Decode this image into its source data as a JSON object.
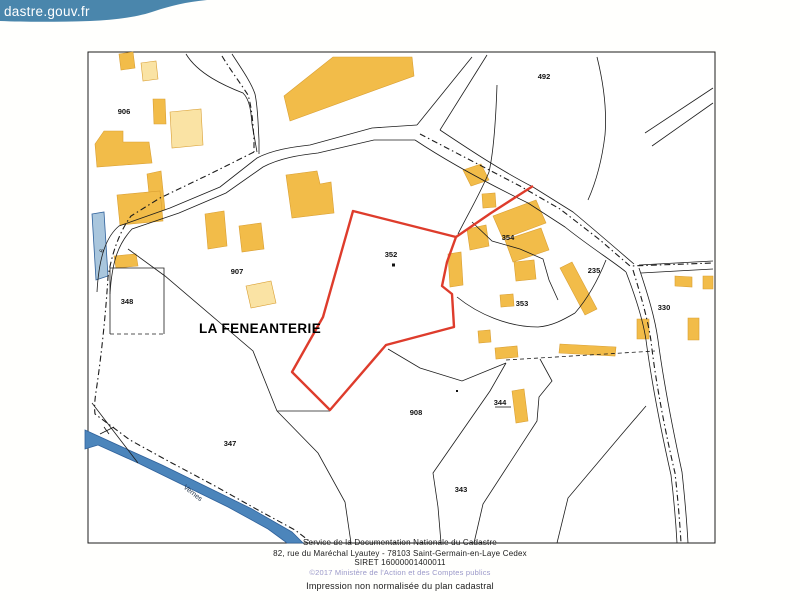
{
  "banner": {
    "logo": "dastre.gouv.fr",
    "background": "#4A86AC",
    "text_color": "#FFFFFF"
  },
  "map": {
    "place": "LA FENEANTERIE",
    "river": "Vernes",
    "road_marker": "6",
    "highlighted_parcel": "352",
    "parcels": {
      "p906": "906",
      "p907": "907",
      "p352": "352",
      "p354": "354",
      "p492": "492",
      "p235": "235",
      "p330": "330",
      "p353": "353",
      "p348": "348",
      "p908": "908",
      "p344": "344",
      "p343": "343",
      "p347": "347"
    },
    "colors": {
      "building": "#F2BC49",
      "building_light": "#FAE3A4",
      "building_stroke": "#D99F33",
      "water": "#4C85BB",
      "water_light": "#A9C6DD",
      "water_stroke": "#2F619B",
      "highlight": "#DE3C2C",
      "line": "#1C1C1C"
    }
  },
  "footer": {
    "line1": "Service de la Documentation Nationale du Cadastre",
    "line2": "82, rue du Maréchal Lyautey - 78103 Saint-Germain-en-Laye Cedex",
    "line3": "SIRET 16000001400011",
    "line4": "©2017 Ministère de l'Action et des Comptes publics",
    "line5": "Impression non normalisée du plan cadastral",
    "copyright_color": "#9B99C9"
  }
}
